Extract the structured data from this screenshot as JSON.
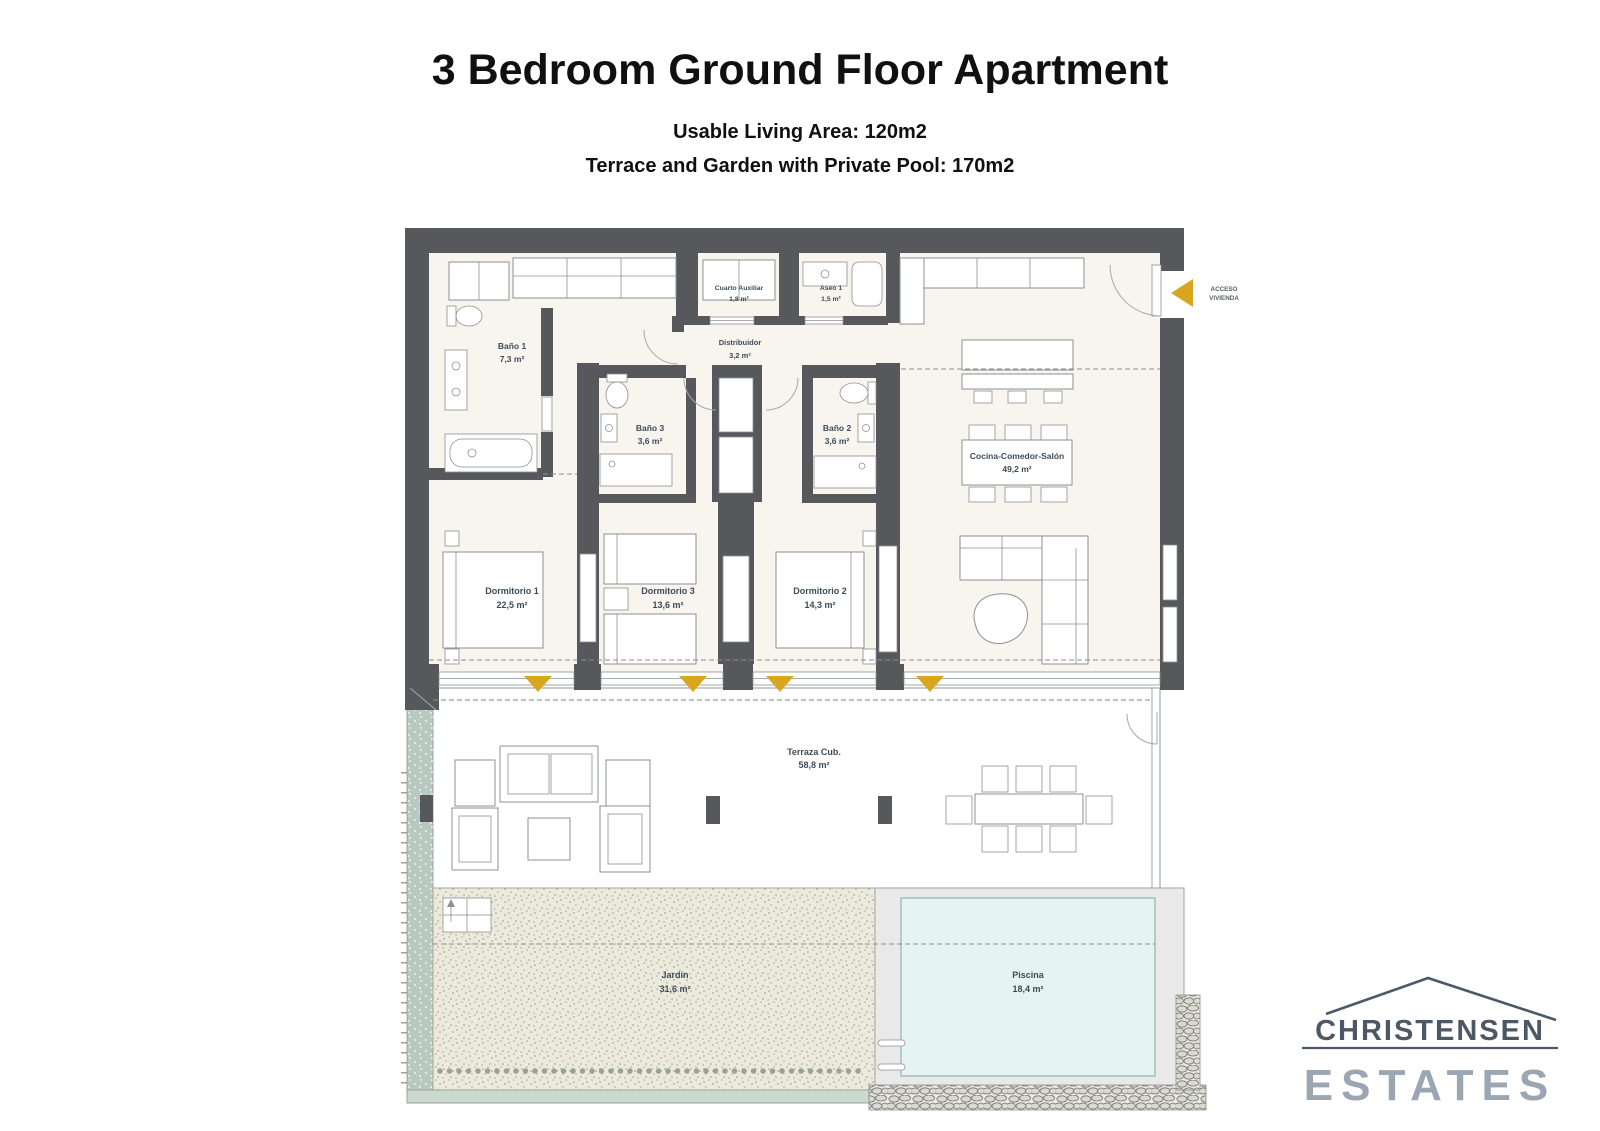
{
  "header": {
    "title": "3 Bedroom Ground Floor Apartment",
    "subtitle1": "Usable Living Area: 120m2",
    "subtitle2": "Terrace and Garden with Private Pool: 170m2"
  },
  "plan": {
    "access": {
      "line1": "ACCESO",
      "line2": "VIVIENDA"
    },
    "rooms": [
      {
        "name": "Baño 1",
        "area": "7,3 m²"
      },
      {
        "name": "Cuarto Auxiliar",
        "area": "1,8 m²"
      },
      {
        "name": "Aseo 1",
        "area": "1,5 m²"
      },
      {
        "name": "Distribuidor",
        "area": "3,2 m²"
      },
      {
        "name": "Baño 3",
        "area": "3,6 m²"
      },
      {
        "name": "Baño 2",
        "area": "3,6 m²"
      },
      {
        "name": "Cocina-Comedor-Salón",
        "area": "49,2 m²"
      },
      {
        "name": "Dormitorio 1",
        "area": "22,5 m²"
      },
      {
        "name": "Dormitorio 3",
        "area": "13,6 m²"
      },
      {
        "name": "Dormitorio 2",
        "area": "14,3 m²"
      },
      {
        "name": "Terraza Cub.",
        "area": "58,8 m²"
      },
      {
        "name": "Jardín",
        "area": "31,6 m²"
      },
      {
        "name": "Piscina",
        "area": "18,4 m²"
      }
    ],
    "colors": {
      "wall": "#56585c",
      "floor": "#f8f4ee",
      "terrace": "#e8e9e8",
      "garden": "#ebeadd",
      "pool": "#e6f4f1",
      "hedge": "#b8c9c1",
      "hedge_light": "#ccd9d0",
      "gold": "#d9a61f",
      "label": "#3c4c57"
    }
  },
  "logo": {
    "name": "CHRISTENSEN",
    "type": "ESTATES",
    "color_primary": "#4d5866",
    "color_secondary": "#9aa6b1"
  }
}
